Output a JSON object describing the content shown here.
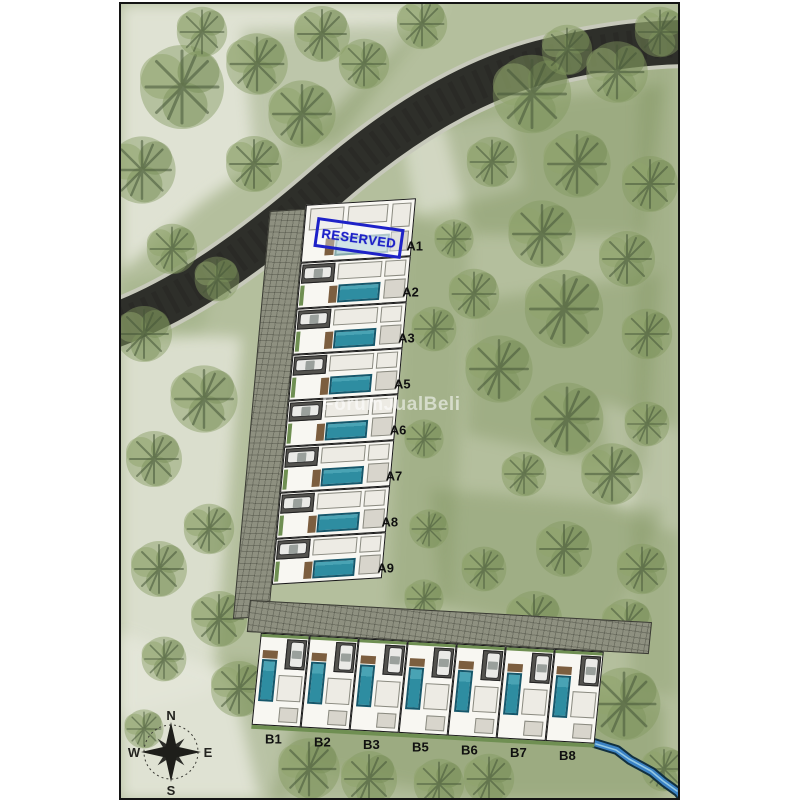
{
  "watermark": "ForumJualBeli",
  "reserved_stamp": "RESERVED",
  "units": {
    "row_a": [
      "A1",
      "A2",
      "A3",
      "A5",
      "A6",
      "A7",
      "A8",
      "A9"
    ],
    "row_b": [
      "B1",
      "B2",
      "B3",
      "B5",
      "B6",
      "B7",
      "B8"
    ],
    "reserved_unit": "A1"
  },
  "compass": {
    "north": "N",
    "east": "E",
    "south": "S",
    "west": "W"
  },
  "colors": {
    "reserved_blue": "#1e22c8",
    "pool_teal": "#2e8da1",
    "asphalt_road": "#2e2f2a",
    "paver_road": "#8e9080",
    "landscape_green": "#b4bf9d",
    "tree_green": "#7e945d",
    "stream_blue": "#3b82c4",
    "label_black": "#101010",
    "watermark_white": "rgba(255,255,255,0.55)"
  }
}
